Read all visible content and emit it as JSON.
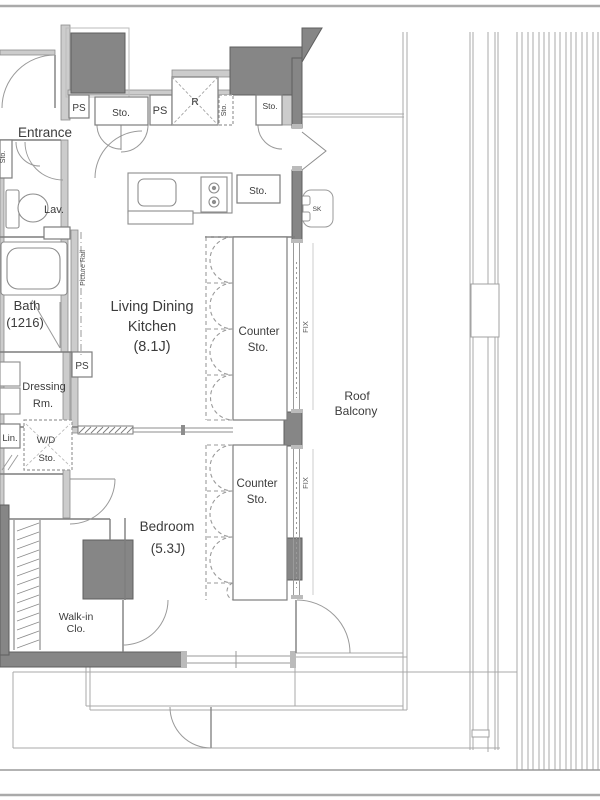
{
  "plan": {
    "type": "apartment-floor-plan",
    "colors": {
      "wall_dark": "#868686",
      "wall_light": "#cccccc",
      "line": "#999999",
      "text": "#3c3c3c",
      "background": "#ffffff"
    },
    "labels": {
      "entrance": "Entrance",
      "lav": "Lav.",
      "bath1": "Bath",
      "bath2": "(1216)",
      "dressing1": "Dressing",
      "dressing2": "Rm.",
      "ldk1": "Living Dining",
      "ldk2": "Kitchen",
      "ldk3": "(8.1J)",
      "bedroom1": "Bedroom",
      "bedroom2": "(5.3J)",
      "wic1": "Walk-in",
      "wic2": "Clo.",
      "roof1": "Roof",
      "roof2": "Balcony",
      "counter_upper1": "Counter",
      "counter_upper2": "Sto.",
      "counter_lower1": "Counter",
      "counter_lower2": "Sto.",
      "lin": "Lin.",
      "wd1": "W/D",
      "wd2": "Sto.",
      "ps_entrance": "PS",
      "ps_kitchen": "PS",
      "ps_bath": "PS",
      "refrigerator": "R",
      "sto_hall_top": "Sto.",
      "sto_strip": "Sto.",
      "sto_upper_right": "Sto.",
      "sto_kitchen": "Sto.",
      "sto_shoe": "Sto.",
      "sk": "SK",
      "fix_upper": "FIX",
      "fix_lower": "FIX",
      "picture_rail": "Picture Rail"
    }
  }
}
